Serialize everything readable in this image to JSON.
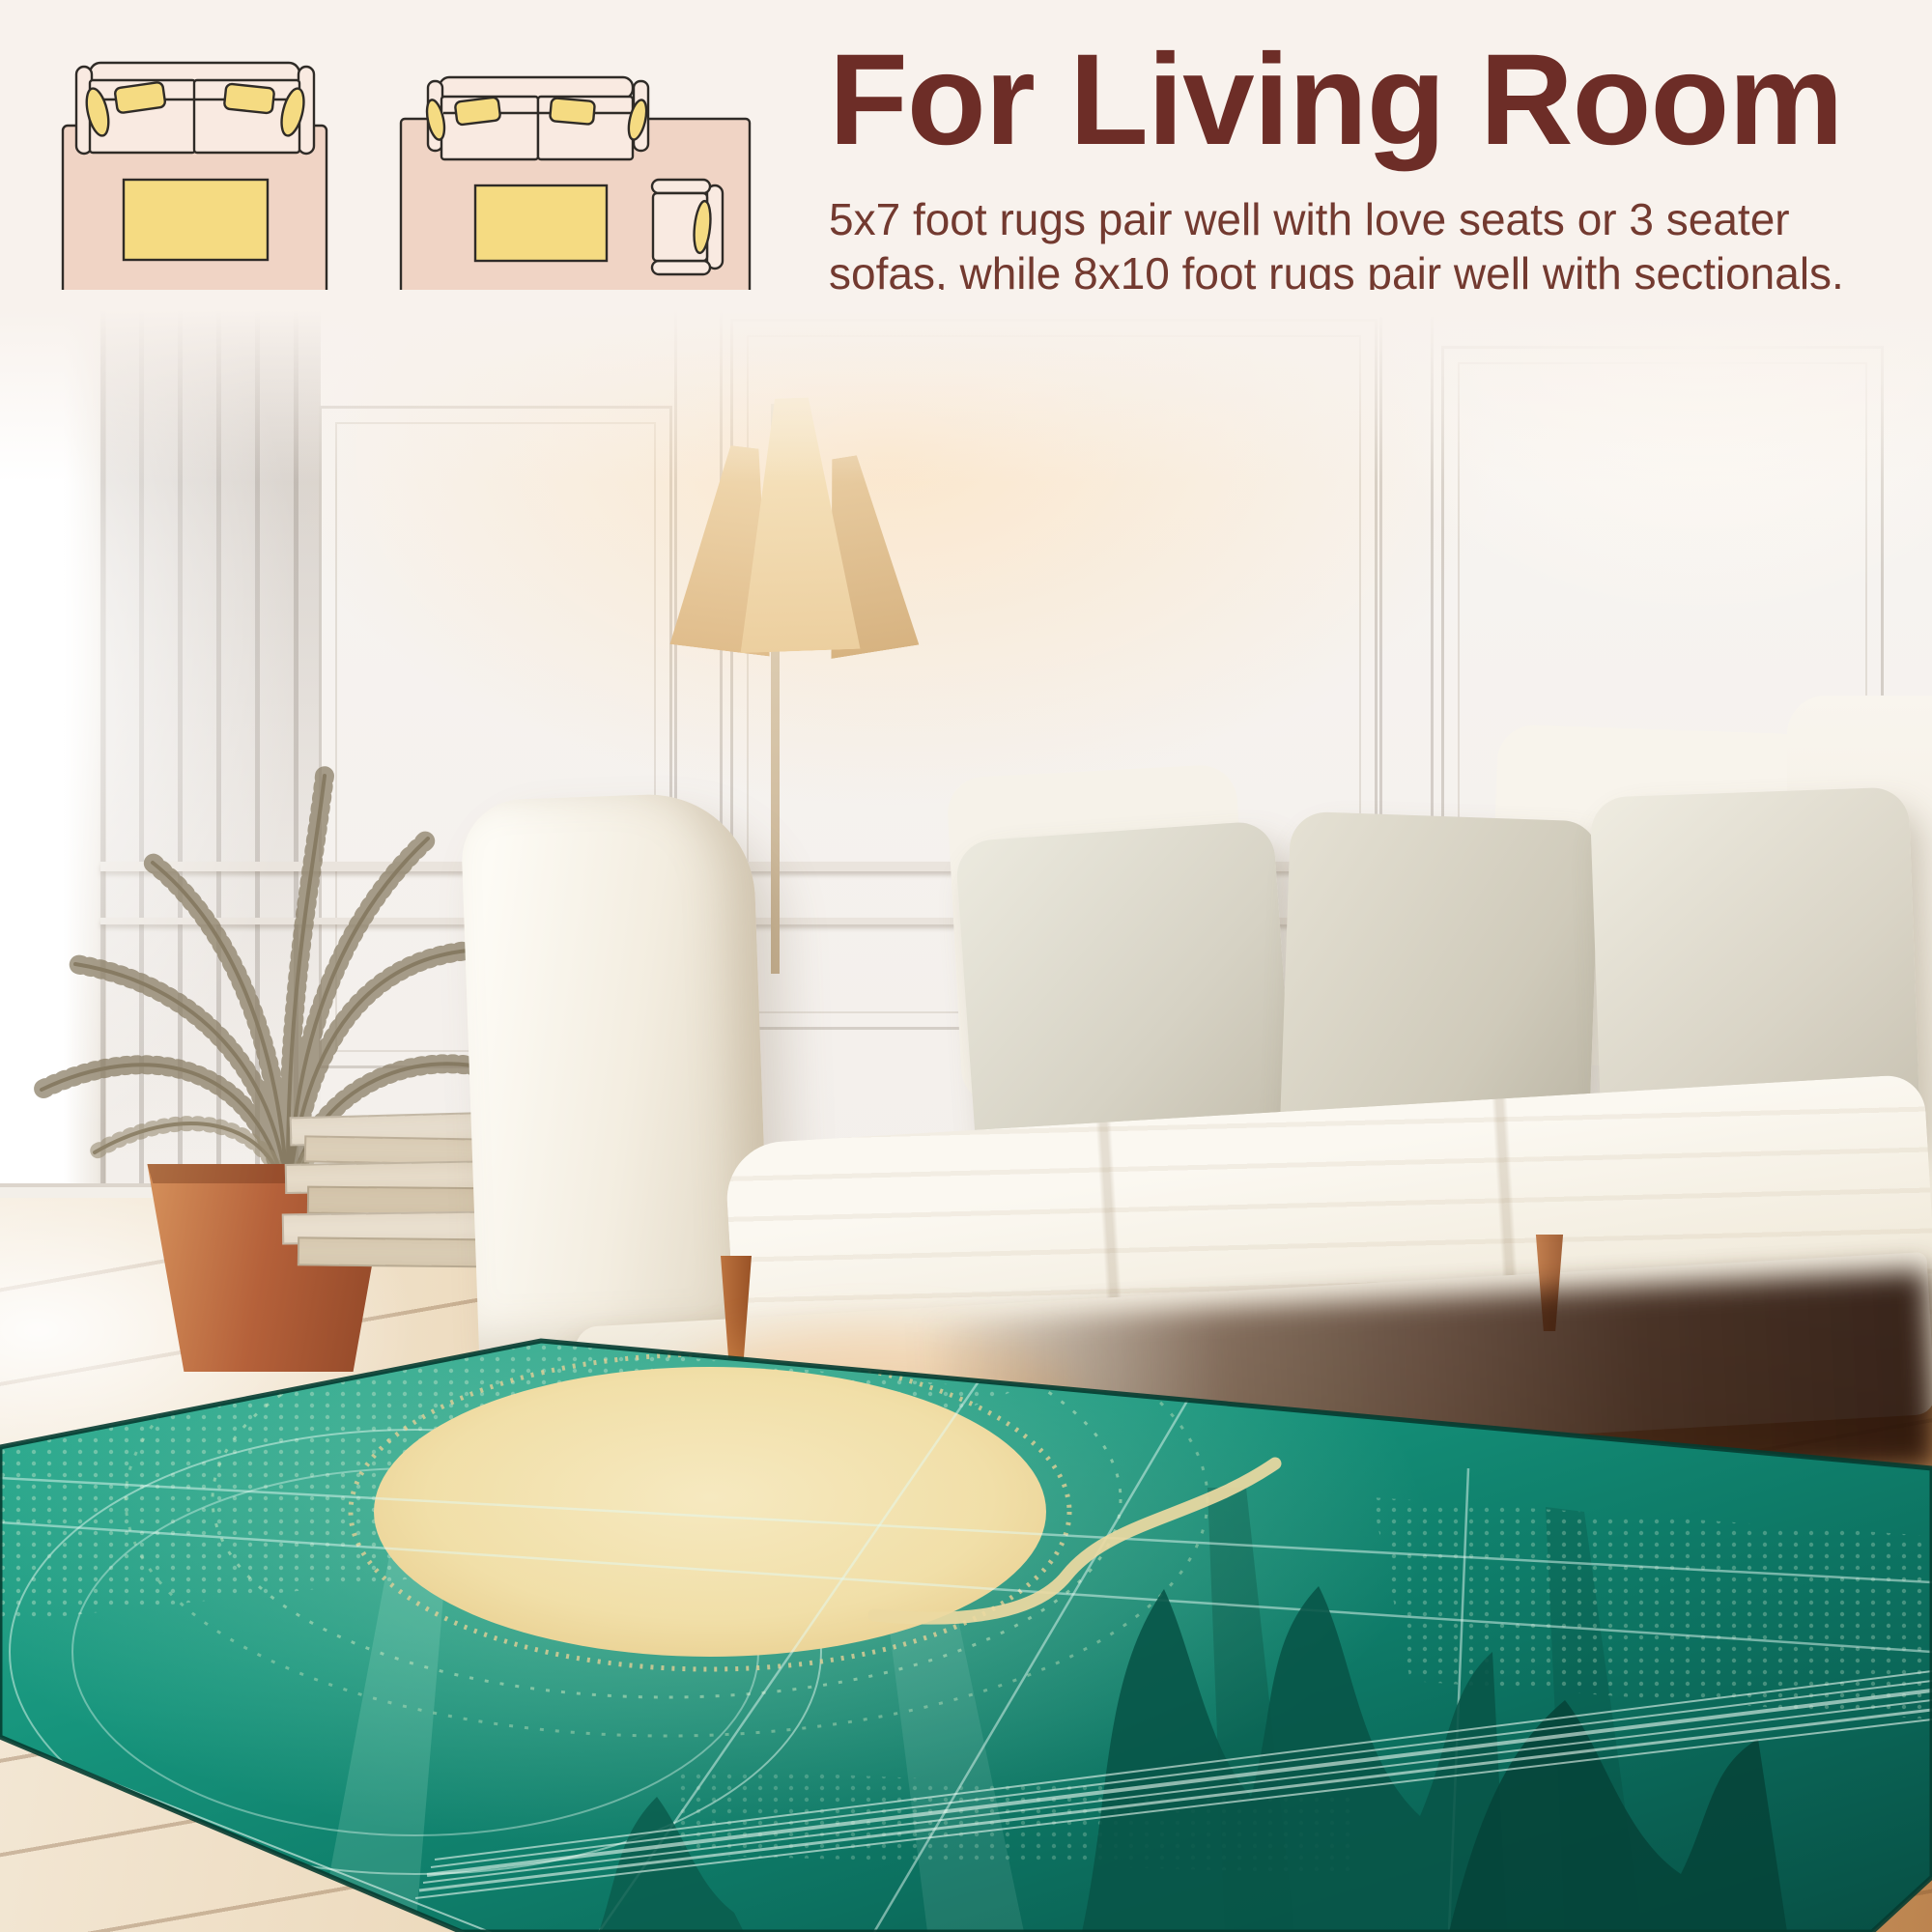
{
  "infographic": {
    "heading": "For Living Room",
    "body_lines": [
      "5x7 foot rugs pair well with love seats or 3 seater",
      "sofas, while 8x10 foot rugs pair well with sectionals."
    ],
    "diagrams": [
      {
        "label": "5x7",
        "depicts": "love seat sofa with 5x7 rug and coffee table"
      },
      {
        "label": "8x10",
        "depicts": "3 seater sofa with 8x10 rug, coffee table and armchair"
      }
    ]
  },
  "palette": {
    "background_cream": "#f8f2ed",
    "heading_maroon": "#6d2d27",
    "body_maroon": "#733a30",
    "diagram_label_brown": "#6b5741",
    "diagram_rug_pink": "#f0d4c5",
    "diagram_sofa_pink": "#f9eae1",
    "diagram_accent_yellow": "#f5db82",
    "diagram_outline": "#2f2b27",
    "rug_teal_bright": "#2aa78b",
    "rug_teal_dark": "#0a5f52",
    "rug_sun_cream": "#f3e3b1",
    "sofa_white": "#f7f3eb",
    "pillow_greige": "#d8d3c6",
    "floor_wood": "#ddbf97",
    "pot_terracotta": "#b5613a"
  },
  "scene": {
    "objects": [
      "paneled-wall",
      "window-light",
      "floor-lamp",
      "dried-palm-plant",
      "terracotta-pot",
      "book-stack",
      "leaning-frames",
      "vase",
      "white-sofa",
      "throw-pillows",
      "wood-floor",
      "teal-sun-art-rug"
    ],
    "rug_design": "abstract emerald teal rug with large cream sun circle, halftone dot arcs, fine light grid lines and dark teal waves"
  }
}
